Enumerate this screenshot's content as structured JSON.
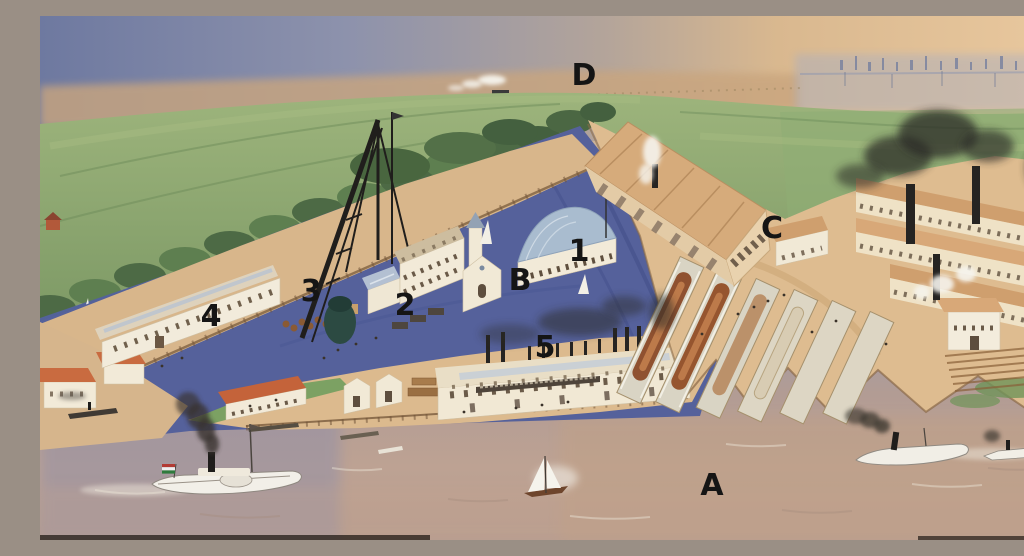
{
  "scene": {
    "elements": [
      "distant-city-haze",
      "steam-train",
      "green-fields",
      "riverbank-trees",
      "upper-river",
      "mainland-pier",
      "derrick-crane",
      "shipyard-island",
      "engine-works-hall",
      "slipways-with-hulls",
      "big-ship-hall",
      "factory-halls",
      "foreground-river",
      "paddle-steamers",
      "sailboats"
    ]
  },
  "annotations": {
    "style": {
      "color": "#151515",
      "font_px": 30
    },
    "items": [
      {
        "id": "label-d",
        "text": "D",
        "x": 544,
        "y": 60
      },
      {
        "id": "label-c",
        "text": "C",
        "x": 732,
        "y": 213
      },
      {
        "id": "label-1",
        "text": "1",
        "x": 539,
        "y": 236
      },
      {
        "id": "label-b",
        "text": "B",
        "x": 480,
        "y": 265
      },
      {
        "id": "label-3",
        "text": "3",
        "x": 271,
        "y": 276
      },
      {
        "id": "label-2",
        "text": "2",
        "x": 365,
        "y": 290
      },
      {
        "id": "label-4",
        "text": "4",
        "x": 171,
        "y": 301
      },
      {
        "id": "label-5",
        "text": "5",
        "x": 505,
        "y": 332
      },
      {
        "id": "label-a",
        "text": "A",
        "x": 672,
        "y": 470
      }
    ]
  },
  "palette": {
    "label_black": "#151515",
    "haze_blue": "#6e79a0",
    "haze_peach": "#e9c89e",
    "field_green": "#8aa470",
    "tree_green": "#4d6a45",
    "river_blue": "#55619b",
    "channel_violet": "#8b8dab",
    "foreground_water_tan": "#b79d90",
    "sand_tan": "#d8b68b",
    "wall_cream": "#f2ead8",
    "roof_tan": "#d6ab7b",
    "roof_glass_blue": "#b3c0d2",
    "roof_red": "#c96b40",
    "hull_brown": "#8f5130",
    "smoke_black": "#2c2a28",
    "steam_white": "#f6f4ee"
  }
}
